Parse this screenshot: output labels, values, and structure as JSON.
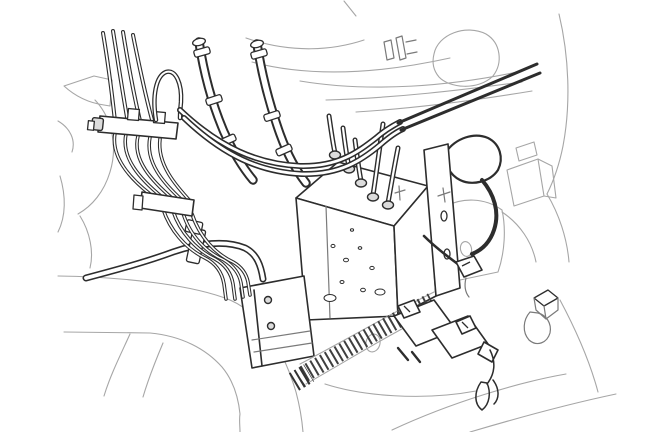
{
  "figure": {
    "type": "line-art-technical-illustration",
    "description": "Black-and-white service-manual line drawing of a vehicle engine compartment showing the ABS hydraulic control unit with brake pipes, flexible hoses, pipe clamp brackets, a corrugated harness sleeve and electrical connectors near the strut tower and wheel arch.",
    "colors": {
      "ink": "#2d2d2d",
      "faint_line": "#a6a6a6",
      "background": "#ffffff"
    },
    "parts": [
      "brake-pipe-bundle",
      "upper-pipe-clamp-bracket",
      "lower-pipe-clamp-bracket",
      "flexible-brake-hoses",
      "long-brake-pipe-pair",
      "abs-hydraulic-unit",
      "tube-nut-fittings",
      "mounting-bracket",
      "pump-motor-block",
      "hose-with-worm-clamp",
      "corrugated-sleeve",
      "harness-connector-blocks",
      "abs-wire-connector",
      "grommet-plug",
      "wheel-arch-outline",
      "body-panel-outlines"
    ]
  }
}
